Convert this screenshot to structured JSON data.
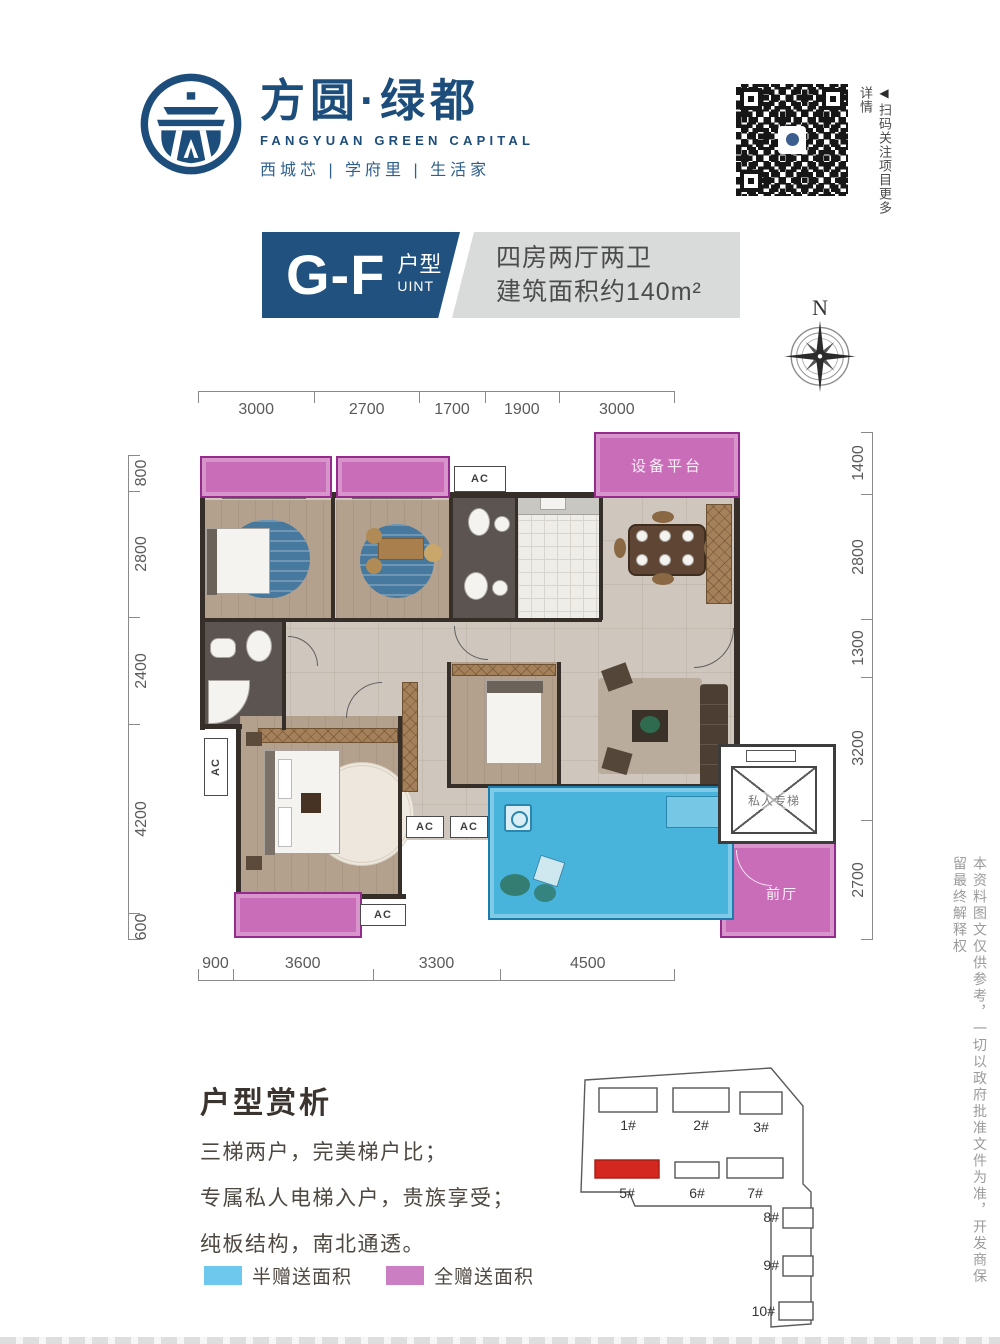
{
  "brand": {
    "name_cn": "方圆·绿都",
    "name_en": "FANGYUAN GREEN CAPITAL",
    "tagline": "西城芯 | 学府里 | 生活家",
    "blue": "#1d4d7b"
  },
  "qr": {
    "caption": "扫码关注项目更多详情",
    "arrow": "◀"
  },
  "title_block": {
    "unit_code": "G-F",
    "unit_label_cn": "户型",
    "unit_label_en": "UINT",
    "desc_line1": "四房两厅两卫",
    "desc_line2": "建筑面积约140m²"
  },
  "compass": {
    "label": "N"
  },
  "dimensions": {
    "top": [
      "3000",
      "2700",
      "1700",
      "1900",
      "3000"
    ],
    "bottom": [
      "900",
      "3600",
      "3300",
      "4500"
    ],
    "left": [
      "800",
      "2800",
      "2400",
      "4200",
      "600"
    ],
    "right": [
      "1400",
      "2800",
      "1300",
      "3200",
      "2700"
    ]
  },
  "plan_labels": {
    "equipment_platform": "设备平台",
    "private_elevator": "私人专梯",
    "front_hall": "前厅",
    "ac": "AC"
  },
  "analysis": {
    "heading": "户型赏析",
    "lines": [
      "三梯两户，完美梯户比；",
      "专属私人电梯入户，贵族享受；",
      "纯板结构，南北通透。"
    ]
  },
  "legend": [
    {
      "label": "半赠送面积",
      "color": "#6ec7ec"
    },
    {
      "label": "全赠送面积",
      "color": "#cb7fc2"
    }
  ],
  "site_plan": {
    "buildings": [
      "1#",
      "2#",
      "3#",
      "5#",
      "6#",
      "7#",
      "8#",
      "9#",
      "10#"
    ],
    "highlighted": "5#",
    "highlight_color": "#d3271f"
  },
  "disclaimer": "本资料图文仅供参考，一切以政府批准文件为准，开发商保留最终解释权"
}
